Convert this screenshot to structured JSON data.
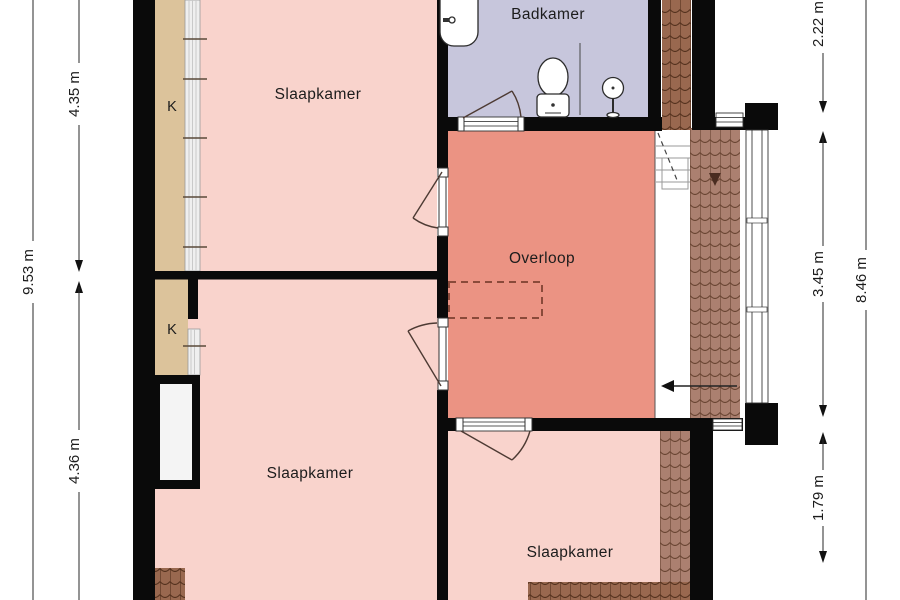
{
  "rooms": [
    {
      "label": "Slaapkamer"
    },
    {
      "label": "Badkamer"
    },
    {
      "label": "Overloop"
    },
    {
      "label": "Slaapkamer"
    },
    {
      "label": "Slaapkamer"
    }
  ],
  "closets": [
    {
      "label": "K"
    },
    {
      "label": "K"
    }
  ],
  "dimensions": {
    "left": [
      {
        "label": "9.53 m"
      },
      {
        "label": "4.35 m"
      },
      {
        "label": "4.36 m"
      }
    ],
    "right": [
      {
        "label": "2.22 m"
      },
      {
        "label": "3.45 m"
      },
      {
        "label": "8.46 m"
      },
      {
        "label": "1.79 m"
      }
    ]
  },
  "colors": {
    "bedroom": "#f9d3cc",
    "landing": "#eb9383",
    "bathroom": "#c7c6dc",
    "closet": "#dcc39b",
    "roof-dark": "#99684f",
    "roof-light": "#ab8070",
    "wall": "#0a0a0a",
    "label-text": "#1c1c1c"
  }
}
